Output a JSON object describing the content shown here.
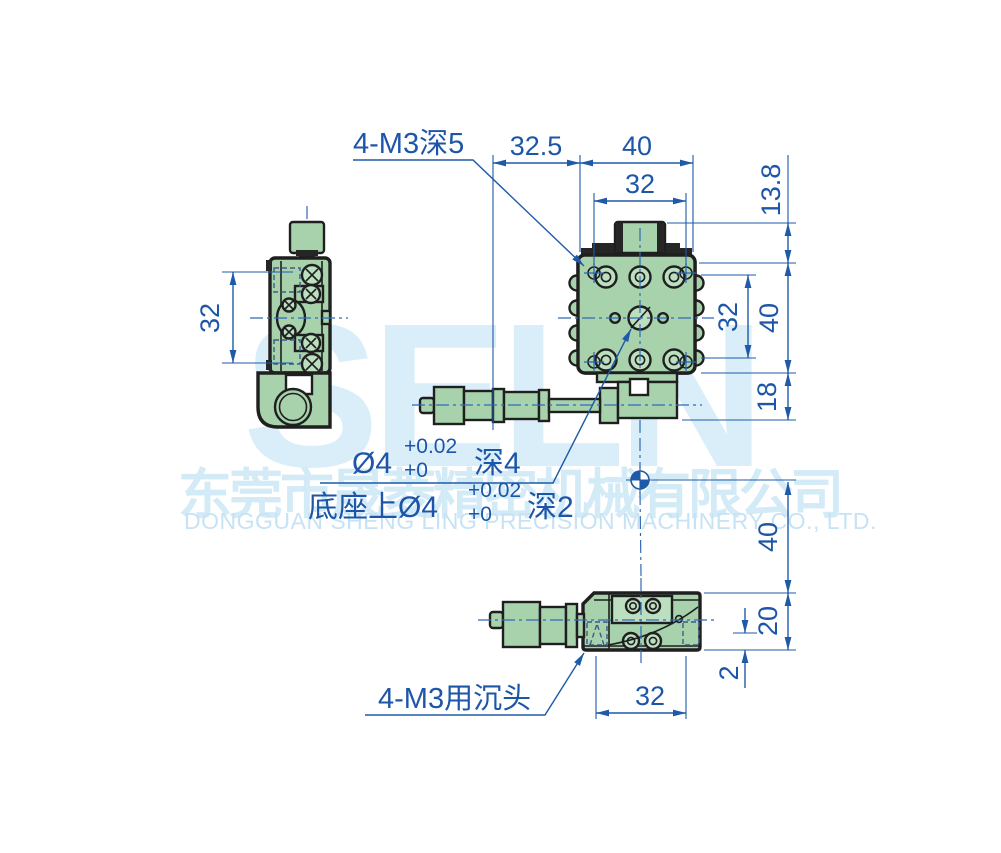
{
  "watermark": {
    "brand": "SELN",
    "company_cn": "东莞市晟菱精密机械有限公司",
    "company_en": "DONGGUAN SHENG LING PRECISION MACHINERY CO., LTD."
  },
  "annotations": {
    "top_thread_note": "4-M3深5",
    "center_hole": {
      "prefix": "Ø4",
      "tol_upper": "+0.02",
      "tol_lower": "+0",
      "depth": "深4"
    },
    "base_hole": {
      "prefix": "底座上Ø4",
      "tol_upper": "+0.02",
      "tol_lower": "+0",
      "depth": "深2"
    },
    "countersunk_note": "4-M3用沉头"
  },
  "dimensions": {
    "side_hole_span": "32",
    "micrometer_offset": "32.5",
    "stage_width": "40",
    "hole_span_top": "32",
    "knob_height": "13.8",
    "hole_span_right": "32",
    "stage_height": "40",
    "base_height": "18",
    "center_to_base": "40",
    "front_height": "20",
    "countersink_offset": "2",
    "front_hole_span": "32"
  },
  "colors": {
    "body_green": "#a7d2ac",
    "outline": "#1f1f1f",
    "dimension_blue": "#1e5aa8",
    "watermark_blue": "#d9eef8"
  }
}
